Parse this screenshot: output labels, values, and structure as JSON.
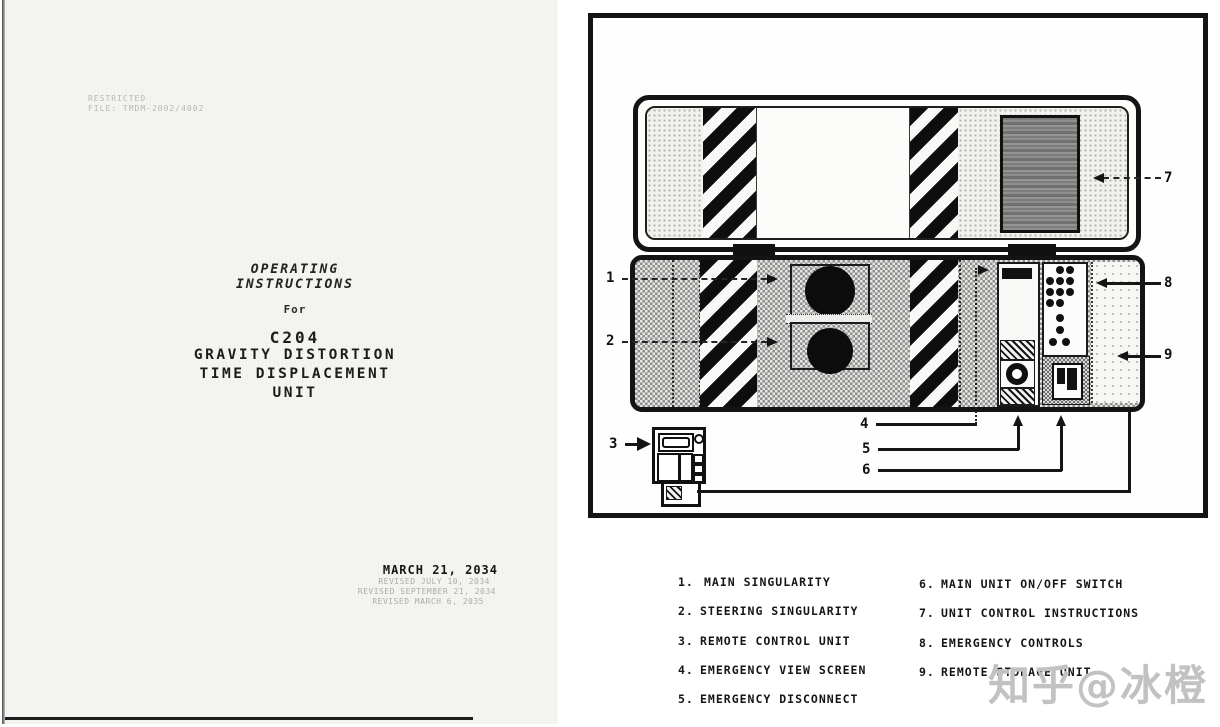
{
  "cover_page": {
    "classification": [
      "RESTRICTED",
      "FILE: TMDM-2002/4002"
    ],
    "heading": [
      "OPERATING",
      "INSTRUCTIONS"
    ],
    "for_label": "For",
    "title": [
      "C204",
      "GRAVITY DISTORTION",
      "TIME DISPLACEMENT",
      "UNIT"
    ],
    "date": "MARCH 21, 2034",
    "revisions": [
      "REVISED JULY 10, 2034",
      "REVISED SEPTEMBER 21, 2034",
      "REVISED MARCH 6, 2035"
    ]
  },
  "figure": {
    "callouts": [
      "1",
      "2",
      "3",
      "4",
      "5",
      "6",
      "7",
      "8",
      "9"
    ]
  },
  "legend": {
    "left": [
      {
        "num": "1.",
        "label": "MAIN SINGULARITY"
      },
      {
        "num": "2.",
        "label": "STEERING SINGULARITY"
      },
      {
        "num": "3.",
        "label": "REMOTE CONTROL UNIT"
      },
      {
        "num": "4.",
        "label": "EMERGENCY VIEW SCREEN"
      },
      {
        "num": "5.",
        "label": "EMERGENCY DISCONNECT"
      }
    ],
    "right": [
      {
        "num": "6.",
        "label": "MAIN UNIT ON/OFF SWITCH"
      },
      {
        "num": "7.",
        "label": "UNIT CONTROL INSTRUCTIONS"
      },
      {
        "num": "8.",
        "label": "EMERGENCY CONTROLS"
      },
      {
        "num": "9.",
        "label": "REMOTE STORAGE UNIT"
      }
    ]
  },
  "watermark": "知乎@冰橙",
  "colors": {
    "ink": "#141414",
    "paper": "#f4f4f1",
    "screen_gray": "#8d8d8d",
    "watermark_gray": "#c2c2c2"
  }
}
